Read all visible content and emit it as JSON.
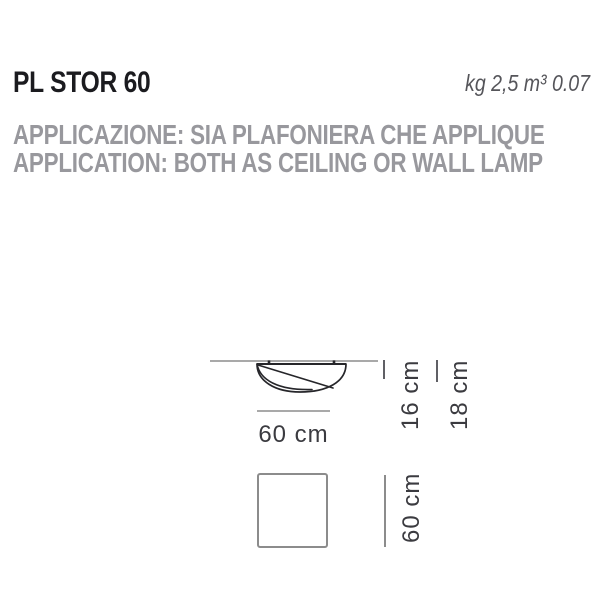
{
  "header": {
    "product_code": "PL STOR 60",
    "weight_volume": "kg 2,5 m³ 0.07"
  },
  "application": {
    "line_it": "APPLICAZIONE: SIA PLAFONIERA CHE APPLIQUE",
    "line_en": "APPLICATION: BOTH AS CEILING OR WALL LAMP"
  },
  "side_view": {
    "diameter_label": "60 cm",
    "body_height_label": "16 cm",
    "total_height_label": "18 cm"
  },
  "plan_view": {
    "side_label": "60 cm"
  },
  "colors": {
    "title_black": "#1b1b1f",
    "application_gray": "#98989d",
    "spec_gray": "#55555a",
    "line_gray": "#a9a9a9",
    "square_gray": "#8c8c8c",
    "dimension_text": "#3b3b40",
    "drawing_black": "#26262a"
  }
}
